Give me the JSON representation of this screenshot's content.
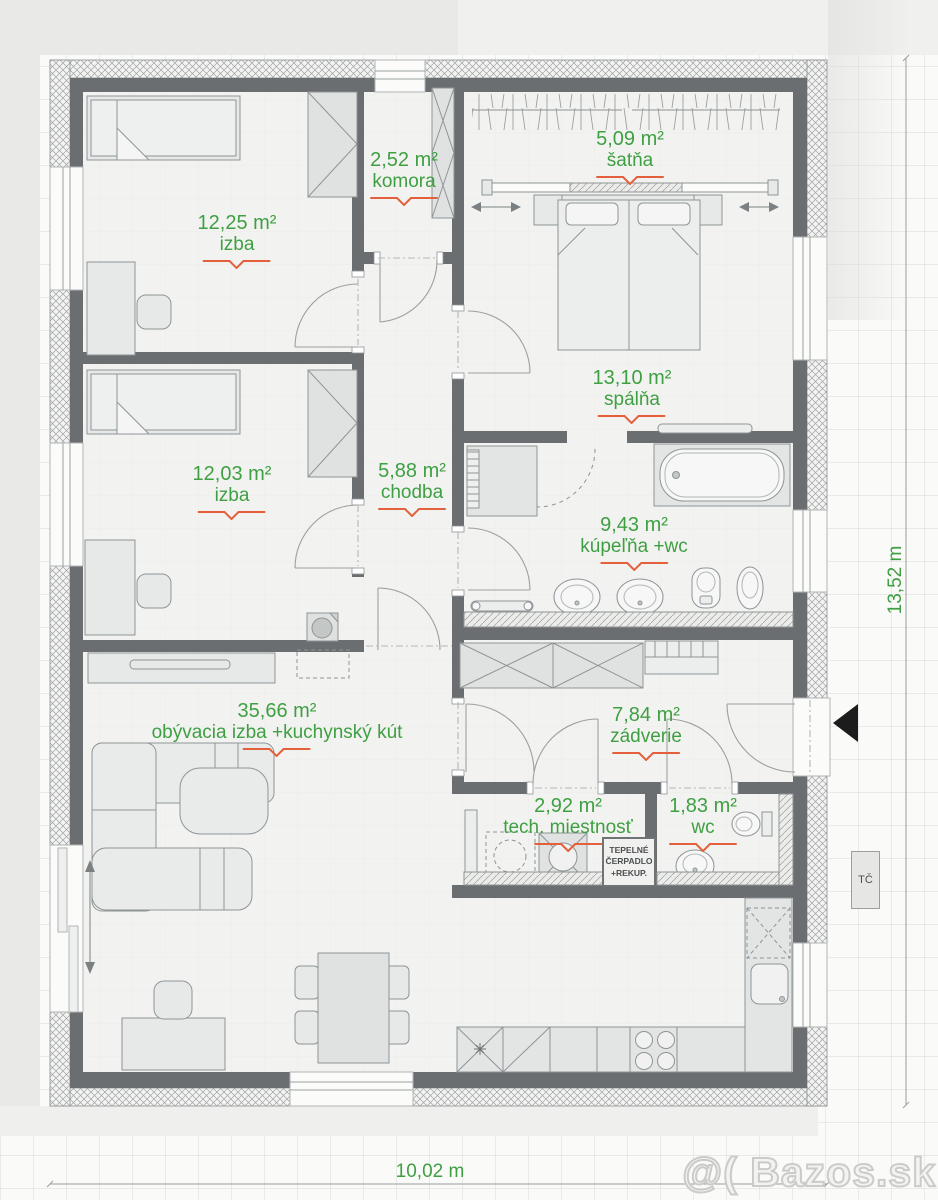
{
  "watermark": "@( Bazos.sk",
  "dimensions": {
    "width": "10,02 m",
    "height": "13,52 m"
  },
  "outdoor_unit_label": "TČ",
  "equipment_box": {
    "line1": "TEPELNÉ",
    "line2": "ČERPADLO",
    "line3": "+REKUP."
  },
  "rooms": [
    {
      "id": "izba-1",
      "area": "12,25 m²",
      "name": "izba"
    },
    {
      "id": "komora",
      "area": "2,52 m²",
      "name": "komora"
    },
    {
      "id": "satna",
      "area": "5,09 m²",
      "name": "šatňa"
    },
    {
      "id": "spalna",
      "area": "13,10 m²",
      "name": "spálňa"
    },
    {
      "id": "izba-2",
      "area": "12,03 m²",
      "name": "izba"
    },
    {
      "id": "chodba",
      "area": "5,88 m²",
      "name": "chodba"
    },
    {
      "id": "kupelna",
      "area": "9,43 m²",
      "name": "kúpeľňa +wc"
    },
    {
      "id": "obyvacia",
      "area": "35,66 m²",
      "name": "obývacia izba +kuchynský kút"
    },
    {
      "id": "zadverie",
      "area": "7,84 m²",
      "name": "zádverie"
    },
    {
      "id": "tech",
      "area": "2,92 m²",
      "name": "tech. miestnosť"
    },
    {
      "id": "wc",
      "area": "1,83 m²",
      "name": "wc"
    }
  ],
  "colors": {
    "label_green": "#3f9f43",
    "underline_orange": "#e4603c",
    "wall_gray": "#6a6e70"
  }
}
